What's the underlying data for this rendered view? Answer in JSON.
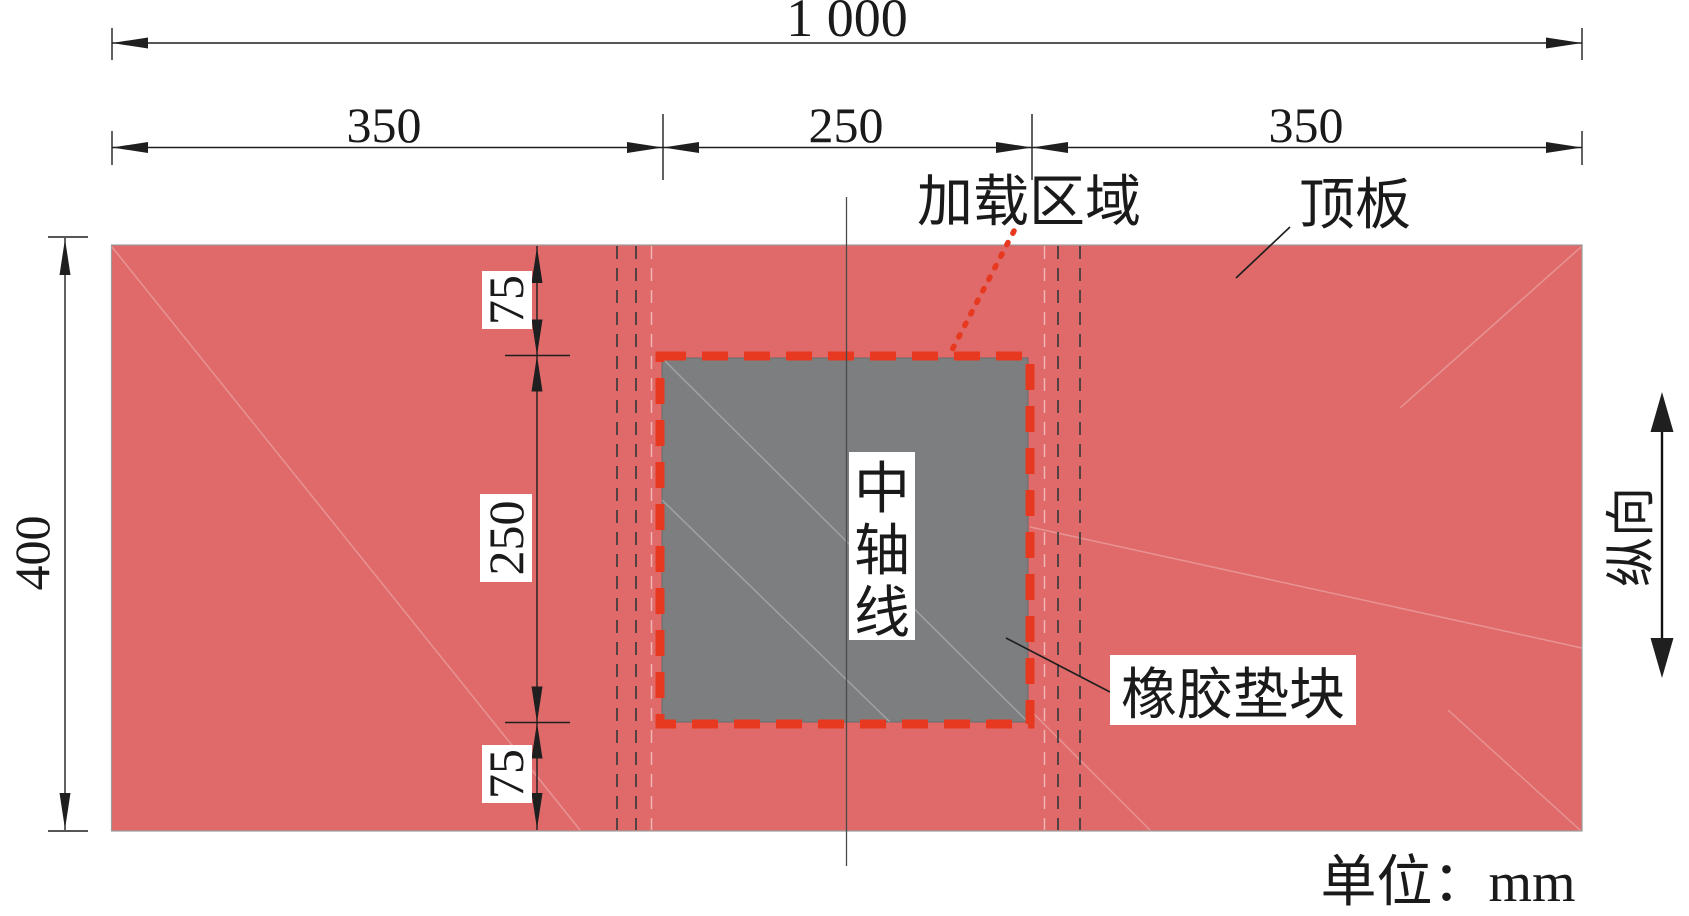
{
  "figure": {
    "type": "engineering-dimension-diagram",
    "unit_note": "单位：mm"
  },
  "dims": {
    "total_width": "1 000",
    "segments": [
      "350",
      "250",
      "350"
    ],
    "total_height": "400",
    "vertical": [
      "75",
      "250",
      "75"
    ]
  },
  "labels": {
    "loading_area": "加载区域",
    "top_plate": "顶板",
    "center_axis_chars": [
      "中",
      "轴",
      "线"
    ],
    "rubber_pad": "橡胶垫块",
    "longitudinal": "纵向"
  },
  "colors": {
    "plate": "#e06a6a",
    "pad": "#7d7e80",
    "accent_red": "#e6391f",
    "line": "#1f1f1f"
  }
}
